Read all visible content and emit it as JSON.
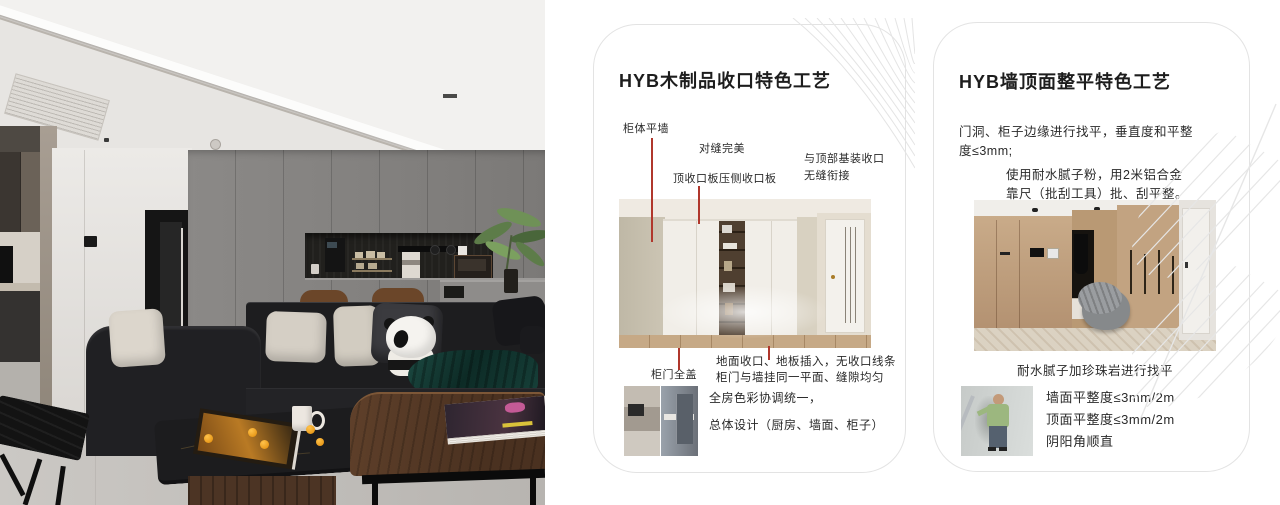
{
  "colors": {
    "accent_red": "#b0372c",
    "card_border": "#e3e3e3",
    "pattern_line": "#e6e6e6"
  },
  "card1": {
    "title": "HYB木制品收口特色工艺",
    "labels": {
      "cabinet_flush_wall": "柜体平墙",
      "perfect_seam": "对缝完美",
      "top_closing_panel": "顶收口板压侧收口板",
      "ceiling_joint_line1": "与顶部基装收口",
      "ceiling_joint_line2": "无缝衔接",
      "full_cover_door": "柜门全盖"
    },
    "notes": {
      "line1": "地面收口、地板插入，无收口线条",
      "line2": "柜门与墙挂同一平面、缝隙均匀"
    },
    "summary": {
      "line1": "全房色彩协调统一，",
      "line2": "总体设计（厨房、墙面、柜子）"
    }
  },
  "card2": {
    "title": "HYB墙顶面整平特色工艺",
    "para1": {
      "line1": "门洞、柜子边缘进行找平，垂直度和平整",
      "line2": "度≤3mm;"
    },
    "para2": {
      "line1": "使用耐水腻子粉，用2米铝合金",
      "line2": "靠尺（批刮工具）批、刮平整。"
    },
    "caption": "耐水腻子加珍珠岩进行找平",
    "specs": {
      "line1": "墙面平整度≤3mm/2m",
      "line2": "顶面平整度≤3mm/2m",
      "line3": "阴阳角顺直"
    }
  }
}
